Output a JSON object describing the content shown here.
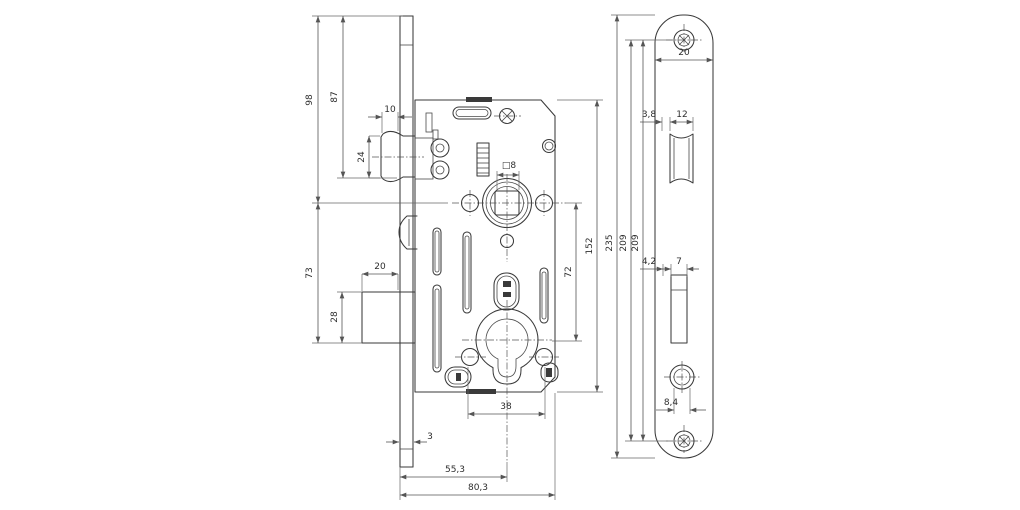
{
  "drawing": {
    "kind": "mortise-lock-technical-drawing",
    "colors": {
      "line": "#3a3a3a",
      "dimension": "#555555",
      "background": "#ffffff"
    },
    "dims": {
      "h98": "98",
      "h87": "87",
      "w10": "10",
      "h24": "24",
      "h73": "73",
      "w20": "20",
      "h28": "28",
      "t3": "3",
      "b553": "55,3",
      "d803": "80,3",
      "s38": "38",
      "sq8": "□8",
      "pz72": "72",
      "c152": "152",
      "p235": "235",
      "s209a": "209",
      "s209b": "209",
      "fw20": "20",
      "l38": "3,8",
      "l12": "12",
      "b42": "4,2",
      "b7": "7",
      "c84": "8,4"
    }
  }
}
